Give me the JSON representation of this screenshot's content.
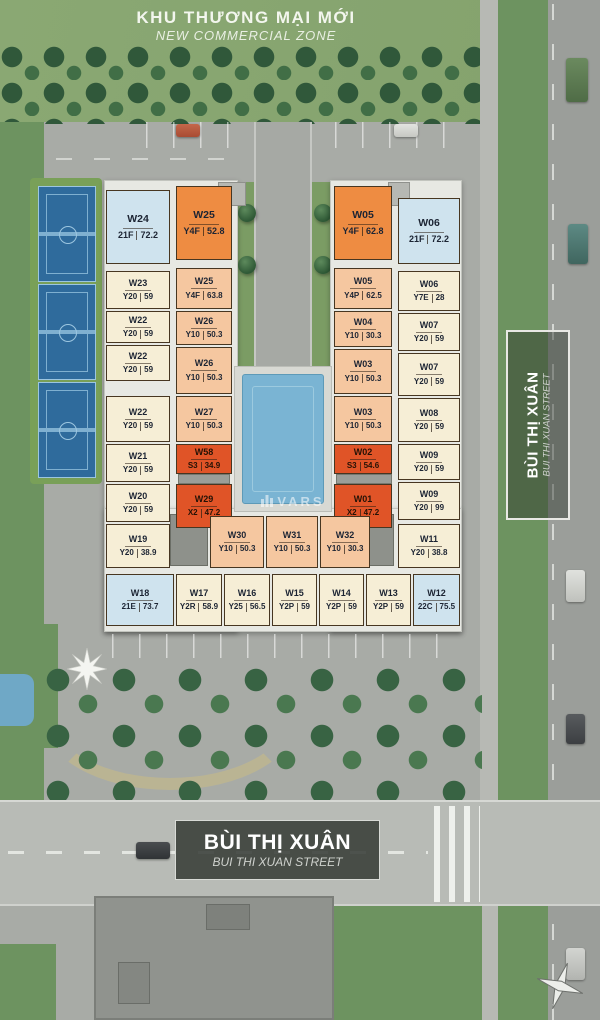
{
  "title": {
    "main": "KHU THƯƠNG MẠI MỚI",
    "sub": "NEW COMMERCIAL ZONE"
  },
  "signs": {
    "bottom_street": {
      "main": "BÙI THỊ XUÂN",
      "sub": "BUI THI XUAN STREET"
    },
    "right_street": {
      "main": "BÙI THỊ XUÂN",
      "sub": "BUI THI XUAN STREET"
    }
  },
  "watermark": "VARS",
  "palette": {
    "unit_cream": "#f6eed6",
    "unit_peach": "#f5c7a0",
    "unit_orange": "#ee8c42",
    "unit_red": "#e05427",
    "unit_blue": "#cfe3ee",
    "unit_border": "#473621",
    "pool": "#7ab4d3",
    "court_blue": "#2f6b9c",
    "grass": "#87a56f",
    "road": "#a8aba6",
    "sign_bg": "#3f4440"
  },
  "units": {
    "left_outer": [
      {
        "id": "W24",
        "type": "21F",
        "area": "72.2",
        "variant": "blue"
      },
      {
        "id": "W23",
        "type": "Y20",
        "area": "59",
        "variant": "cream"
      },
      {
        "id": "W22",
        "type": "Y20",
        "area": "59",
        "variant": "cream"
      },
      {
        "id": "W22",
        "type": "Y20",
        "area": "59",
        "variant": "cream"
      },
      {
        "id": "W22",
        "type": "Y20",
        "area": "59",
        "variant": "cream"
      },
      {
        "id": "W21",
        "type": "Y20",
        "area": "59",
        "variant": "cream"
      },
      {
        "id": "W20",
        "type": "Y20",
        "area": "59",
        "variant": "cream"
      },
      {
        "id": "W19",
        "type": "Y20",
        "area": "38.9",
        "variant": "cream"
      }
    ],
    "left_inner": [
      {
        "id": "W25",
        "type": "Y4F",
        "area": "52.8",
        "variant": "orange"
      },
      {
        "id": "W25",
        "type": "Y4F",
        "area": "63.8",
        "variant": "peach"
      },
      {
        "id": "W26",
        "type": "Y10",
        "area": "50.3",
        "variant": "peach"
      },
      {
        "id": "W26",
        "type": "Y10",
        "area": "50.3",
        "variant": "peach"
      },
      {
        "id": "W27",
        "type": "Y10",
        "area": "50.3",
        "variant": "peach"
      },
      {
        "id": "W58",
        "type": "S3",
        "area": "34.9",
        "variant": "red"
      },
      {
        "id": "W29",
        "type": "X2",
        "area": "47.2",
        "variant": "red"
      }
    ],
    "right_inner": [
      {
        "id": "W05",
        "type": "Y4F",
        "area": "62.8",
        "variant": "orange"
      },
      {
        "id": "W05",
        "type": "Y4P",
        "area": "62.5",
        "variant": "peach"
      },
      {
        "id": "W04",
        "type": "Y10",
        "area": "30.3",
        "variant": "peach"
      },
      {
        "id": "W03",
        "type": "Y10",
        "area": "50.3",
        "variant": "peach"
      },
      {
        "id": "W03",
        "type": "Y10",
        "area": "50.3",
        "variant": "peach"
      },
      {
        "id": "W02",
        "type": "S3",
        "area": "54.6",
        "variant": "red"
      },
      {
        "id": "W01",
        "type": "X2",
        "area": "47.2",
        "variant": "red"
      }
    ],
    "right_outer": [
      {
        "id": "W06",
        "type": "21F",
        "area": "72.2",
        "variant": "blue"
      },
      {
        "id": "W06",
        "type": "Y7E",
        "area": "28",
        "variant": "cream"
      },
      {
        "id": "W07",
        "type": "Y20",
        "area": "59",
        "variant": "cream"
      },
      {
        "id": "W07",
        "type": "Y20",
        "area": "59",
        "variant": "cream"
      },
      {
        "id": "W08",
        "type": "Y20",
        "area": "59",
        "variant": "cream"
      },
      {
        "id": "W09",
        "type": "Y20",
        "area": "59",
        "variant": "cream"
      },
      {
        "id": "W09",
        "type": "Y20",
        "area": "99",
        "variant": "cream"
      },
      {
        "id": "W11",
        "type": "Y20",
        "area": "38.8",
        "variant": "cream"
      }
    ],
    "bottom_inner": [
      {
        "id": "W30",
        "type": "Y10",
        "area": "50.3",
        "variant": "peach"
      },
      {
        "id": "W31",
        "type": "Y10",
        "area": "50.3",
        "variant": "peach"
      },
      {
        "id": "W32",
        "type": "Y10",
        "area": "30.3",
        "variant": "peach"
      }
    ],
    "bottom_outer": [
      {
        "id": "W18",
        "type": "21E",
        "area": "73.7",
        "variant": "blue"
      },
      {
        "id": "W17",
        "type": "Y2R",
        "area": "58.9",
        "variant": "cream"
      },
      {
        "id": "W16",
        "type": "Y25",
        "area": "56.5",
        "variant": "cream"
      },
      {
        "id": "W15",
        "type": "Y2P",
        "area": "59",
        "variant": "cream"
      },
      {
        "id": "W14",
        "type": "Y2P",
        "area": "59",
        "variant": "cream"
      },
      {
        "id": "W13",
        "type": "Y2P",
        "area": "59",
        "variant": "cream"
      },
      {
        "id": "W12",
        "type": "22C",
        "area": "75.5",
        "variant": "blue"
      }
    ]
  }
}
